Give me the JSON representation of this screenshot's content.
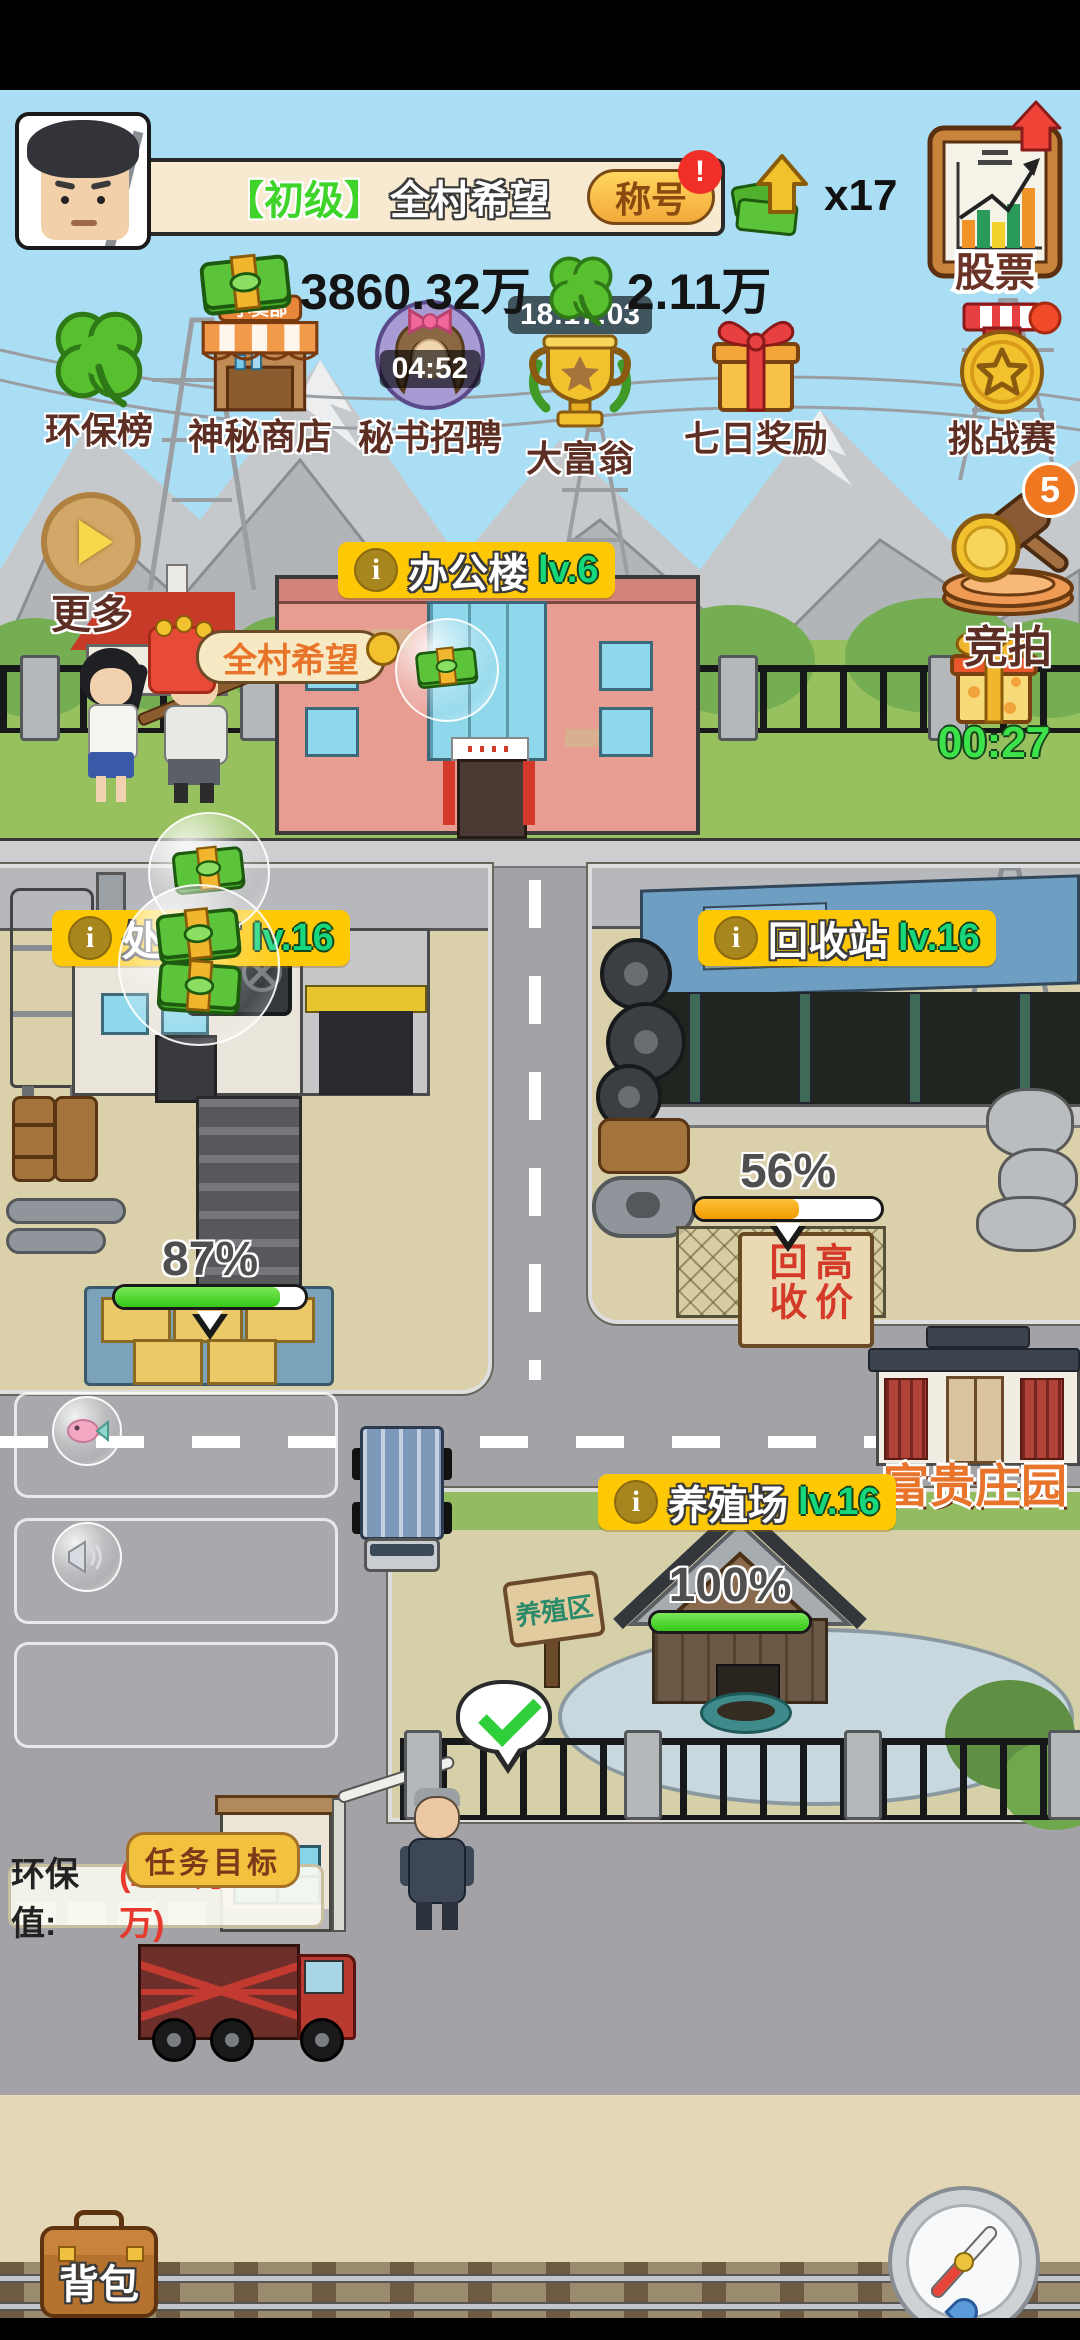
{
  "ui": {
    "info_glyph": "i"
  },
  "hud": {
    "player": {
      "grade": "【初级】",
      "name": "全村希望",
      "title_button": "称号",
      "title_alert": "!"
    },
    "boost": {
      "count": "x17"
    },
    "currencies": {
      "money": "3860.32万",
      "clover": "2.11万"
    },
    "stock": {
      "label": "股票"
    },
    "features": [
      {
        "label": "环保榜"
      },
      {
        "label": "神秘商店",
        "sign": "小卖部"
      },
      {
        "label": "秘书招聘",
        "timer": "04:52"
      },
      {
        "label": "大富翁",
        "timer": "18:17:03"
      },
      {
        "label": "七日奖励"
      },
      {
        "label": "挑战赛"
      }
    ],
    "more": {
      "label": "更多"
    },
    "auction": {
      "label": "竞拍",
      "badge": "5"
    },
    "gift": {
      "timer": "00:27"
    }
  },
  "scene": {
    "village_banner": "全村希望",
    "office": {
      "name": "办公楼",
      "level": "lv.6"
    },
    "plant": {
      "name": "处理厂",
      "level": "lv.16",
      "progress_label": "87%",
      "progress": 87
    },
    "recycle": {
      "name": "回收站",
      "level": "lv.16",
      "progress_label": "56%",
      "progress": 56,
      "sign": "高价回收"
    },
    "farm": {
      "name": "养殖场",
      "level": "lv.16",
      "progress_label": "100%",
      "progress": 100,
      "sign": "养殖区"
    },
    "manor": {
      "name": "富贵庄园"
    }
  },
  "task": {
    "tag": "任务目标",
    "label": "环保值:",
    "value": "(2.11万/2.5万)"
  },
  "bottom": {
    "backpack": "背包"
  },
  "colors": {
    "label_bg": "#fec804",
    "level_green": "#16d77c",
    "progress_green": "#35c818",
    "progress_orange": "#f09a00",
    "env_value_red": "#e8392e",
    "timer_green": "#3ce24a"
  }
}
